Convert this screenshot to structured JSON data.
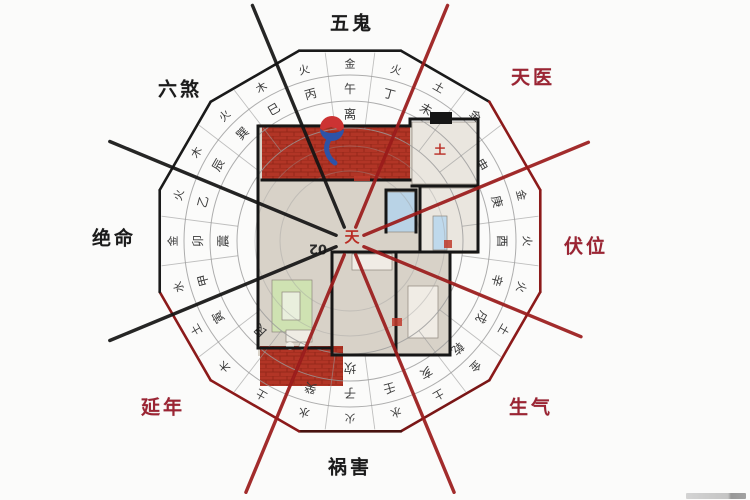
{
  "title": "八宅风水户型方位图",
  "colors": {
    "auspicious_red": "#9b2433",
    "inauspicious_black": "#1b1b1b",
    "spoke_red": "#9b1b1b",
    "spoke_black": "#141414",
    "ring_line": "#9a9a9a",
    "char_ink": "#3a3a3a",
    "brick_red": "#b23526",
    "plan_bg": "#d8d2c8",
    "bath_blue": "#b9d3e6",
    "sofa_green": "#cfe2b2",
    "logo_red": "#cc3333",
    "logo_blue": "#2d53a8"
  },
  "sectors": [
    {
      "id": "wugui",
      "text": "五鬼",
      "x": 352,
      "y": 22,
      "color": "#1b1b1b"
    },
    {
      "id": "tianyi",
      "text": "天医",
      "x": 533,
      "y": 76,
      "color": "#9b2433"
    },
    {
      "id": "fuwei",
      "text": "伏位",
      "x": 586,
      "y": 245,
      "color": "#9b2433"
    },
    {
      "id": "shengqi",
      "text": "生气",
      "x": 531,
      "y": 406,
      "color": "#9b2433"
    },
    {
      "id": "huohai",
      "text": "祸害",
      "x": 350,
      "y": 466,
      "color": "#1b1b1b"
    },
    {
      "id": "yannian",
      "text": "延年",
      "x": 163,
      "y": 406,
      "color": "#9b2433"
    },
    {
      "id": "jueming",
      "text": "绝命",
      "x": 114,
      "y": 237,
      "color": "#1b1b1b"
    },
    {
      "id": "liusha",
      "text": "六煞",
      "x": 180,
      "y": 88,
      "color": "#1b1b1b"
    }
  ],
  "compass": {
    "center": {
      "x": 350,
      "y": 241
    },
    "arc_radii": [
      70,
      95,
      113,
      140,
      166
    ],
    "row_radius": {
      "trigram": 127,
      "mountain": 152,
      "element": 177
    },
    "polygon_radius": 197,
    "divider_inner_r": 113,
    "divider_outer_r": 190,
    "trigrams": [
      {
        "b": 0,
        "c": "离"
      },
      {
        "b": -90,
        "c": "震"
      },
      {
        "b": -135,
        "c": "艮"
      },
      {
        "b": 180,
        "c": "坎"
      }
    ],
    "mountains": [
      {
        "b": -120,
        "c": "寅"
      },
      {
        "b": -105,
        "c": "甲"
      },
      {
        "b": -90,
        "c": "卯"
      },
      {
        "b": -75,
        "c": "乙"
      },
      {
        "b": -60,
        "c": "辰"
      },
      {
        "b": -45,
        "c": "巽"
      },
      {
        "b": -30,
        "c": "巳"
      },
      {
        "b": -15,
        "c": "丙"
      },
      {
        "b": 0,
        "c": "午"
      },
      {
        "b": 15,
        "c": "丁"
      },
      {
        "b": 30,
        "c": "未"
      },
      {
        "b": 60,
        "c": "申"
      },
      {
        "b": 75,
        "c": "庚"
      },
      {
        "b": 90,
        "c": "酉"
      },
      {
        "b": 105,
        "c": "辛"
      },
      {
        "b": 120,
        "c": "戌"
      },
      {
        "b": 135,
        "c": "乾"
      },
      {
        "b": 150,
        "c": "亥"
      },
      {
        "b": 165,
        "c": "壬"
      },
      {
        "b": 180,
        "c": "子"
      },
      {
        "b": -165,
        "c": "癸"
      }
    ],
    "elements": [
      {
        "b": -135,
        "c": "木"
      },
      {
        "b": -120,
        "c": "土"
      },
      {
        "b": -105,
        "c": "水"
      },
      {
        "b": -90,
        "c": "金"
      },
      {
        "b": -75,
        "c": "火"
      },
      {
        "b": -60,
        "c": "木"
      },
      {
        "b": -45,
        "c": "火"
      },
      {
        "b": -30,
        "c": "木"
      },
      {
        "b": -15,
        "c": "火"
      },
      {
        "b": 0,
        "c": "金"
      },
      {
        "b": 15,
        "c": "火"
      },
      {
        "b": 30,
        "c": "土"
      },
      {
        "b": 45,
        "c": "金"
      },
      {
        "b": 75,
        "c": "金"
      },
      {
        "b": 90,
        "c": "火"
      },
      {
        "b": 105,
        "c": "火"
      },
      {
        "b": 120,
        "c": "土"
      },
      {
        "b": 135,
        "c": "金"
      },
      {
        "b": 150,
        "c": "土"
      },
      {
        "b": 165,
        "c": "水"
      },
      {
        "b": 180,
        "c": "火"
      },
      {
        "b": -165,
        "c": "水"
      },
      {
        "b": -150,
        "c": "土"
      }
    ],
    "spokes": [
      {
        "b": 337.5,
        "color": "#141414",
        "len": 255
      },
      {
        "b": 292.5,
        "color": "#141414",
        "len": 260
      },
      {
        "b": 247.5,
        "color": "#141414",
        "len": 260
      },
      {
        "b": 202.5,
        "color": "#9b1b1b",
        "len": 272
      },
      {
        "b": 157.5,
        "color": "#9b1b1b",
        "len": 272
      },
      {
        "b": 112.5,
        "color": "#9b1b1b",
        "len": 250
      },
      {
        "b": 67.5,
        "color": "#9b1b1b",
        "len": 258
      },
      {
        "b": 22.5,
        "color": "#9b1b1b",
        "len": 255
      }
    ],
    "polygon_edges": [
      {
        "b": 0,
        "color": "#1a1a1a"
      },
      {
        "b": 30,
        "color": "#1a1a1a"
      },
      {
        "b": 60,
        "color": "#8c1a1a"
      },
      {
        "b": 90,
        "color": "#8c1a1a"
      },
      {
        "b": 120,
        "color": "#8c1a1a"
      },
      {
        "b": 150,
        "color": "#7a1616"
      },
      {
        "b": 180,
        "color": "#48120f"
      },
      {
        "b": 210,
        "color": "#8c1a1a"
      },
      {
        "b": 240,
        "color": "#8c1a1a"
      },
      {
        "b": 270,
        "color": "#1a1a1a"
      },
      {
        "b": 300,
        "color": "#1a1a1a"
      },
      {
        "b": 330,
        "color": "#1a1a1a"
      }
    ]
  },
  "floor_plan": {
    "base_rects": [
      {
        "x": 258,
        "y": 124,
        "w": 220,
        "h": 130,
        "fill": "#d8d2c8"
      },
      {
        "x": 258,
        "y": 254,
        "w": 192,
        "h": 102,
        "fill": "#d8d2c8"
      }
    ],
    "rooms": [
      {
        "name": "room-topright",
        "x": 412,
        "y": 122,
        "w": 66,
        "h": 62,
        "fill": "#eae6df"
      },
      {
        "name": "room-right",
        "x": 420,
        "y": 188,
        "w": 58,
        "h": 64,
        "fill": "#eae6df"
      },
      {
        "name": "bathroom",
        "x": 386,
        "y": 192,
        "w": 30,
        "h": 40,
        "fill": "#b9d3e6"
      },
      {
        "name": "blue-fixture",
        "x": 433,
        "y": 216,
        "w": 14,
        "h": 34,
        "fill": "#bfd9ec"
      },
      {
        "name": "sofa",
        "x": 272,
        "y": 280,
        "w": 40,
        "h": 52,
        "fill": "#cfe2b2"
      },
      {
        "name": "sofa-inner",
        "x": 282,
        "y": 292,
        "w": 18,
        "h": 28,
        "fill": "#e9efdd"
      },
      {
        "name": "bed-bottom-right",
        "x": 408,
        "y": 286,
        "w": 30,
        "h": 52,
        "fill": "#f0ece5"
      },
      {
        "name": "cabinet-mid",
        "x": 352,
        "y": 254,
        "w": 40,
        "h": 16,
        "fill": "#f0ece5"
      },
      {
        "name": "table",
        "x": 286,
        "y": 330,
        "w": 26,
        "h": 12,
        "fill": "#efece4"
      }
    ],
    "brick_rects": [
      {
        "name": "balcony-top",
        "x": 262,
        "y": 127,
        "w": 148,
        "h": 52
      },
      {
        "name": "balcony-bottom",
        "x": 260,
        "y": 346,
        "w": 83,
        "h": 40
      }
    ],
    "walls": [
      [
        258,
        126,
        410,
        126
      ],
      [
        410,
        126,
        410,
        119
      ],
      [
        410,
        119,
        478,
        119
      ],
      [
        478,
        119,
        478,
        252
      ],
      [
        478,
        252,
        450,
        252
      ],
      [
        450,
        252,
        450,
        355
      ],
      [
        450,
        355,
        332,
        355
      ],
      [
        332,
        355,
        332,
        252
      ],
      [
        332,
        348,
        258,
        348
      ],
      [
        258,
        348,
        258,
        126
      ],
      [
        262,
        180,
        410,
        180
      ],
      [
        412,
        186,
        478,
        186
      ],
      [
        420,
        186,
        420,
        252
      ],
      [
        332,
        252,
        450,
        252
      ],
      [
        396,
        252,
        396,
        355
      ],
      [
        386,
        190,
        416,
        190
      ],
      [
        416,
        190,
        416,
        232
      ],
      [
        386,
        190,
        386,
        232
      ]
    ],
    "chimney": {
      "x": 430,
      "y": 112,
      "w": 22,
      "h": 12
    },
    "red_accents": [
      {
        "x": 444,
        "y": 240,
        "w": 8,
        "h": 8
      },
      {
        "x": 392,
        "y": 318,
        "w": 10,
        "h": 8
      },
      {
        "x": 354,
        "y": 176,
        "w": 16,
        "h": 5
      }
    ],
    "labels": {
      "unit_number": {
        "text": "02",
        "x": 318,
        "y": 248,
        "rotate": 180,
        "color": "#2b2b2b",
        "size": 13
      },
      "center_mark": {
        "text": "天",
        "x": 352,
        "y": 237,
        "rotate": 0,
        "color": "#b92b22",
        "size": 15
      },
      "soil_mark": {
        "text": "土",
        "x": 440,
        "y": 150,
        "rotate": 0,
        "color": "#b92b22",
        "size": 12
      }
    },
    "logo": {
      "x": 332,
      "y": 128
    }
  }
}
